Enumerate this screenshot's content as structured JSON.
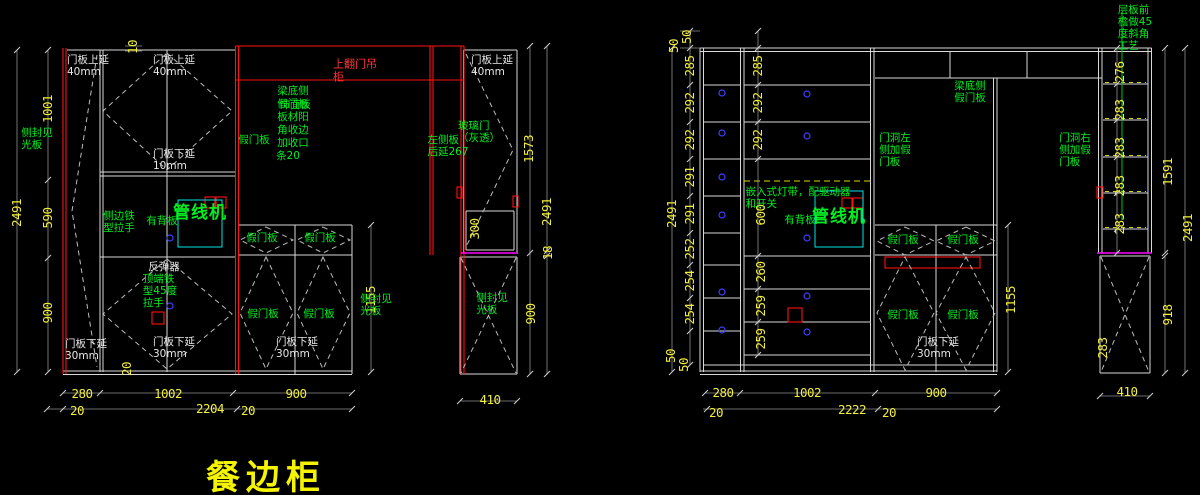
{
  "title": {
    "text": "餐边柜"
  },
  "palette": {
    "background": "#000000",
    "line_white": "#d9d9d9",
    "accent_red": "#ff1111",
    "annotation_green": "#00ee22",
    "dimension_yellow": "#f2ee3c",
    "highlight_cyan": "#00e5e5",
    "counter_magenta": "#ff00ff",
    "mark_blue": "#4040ff",
    "light_strip_yellow": "#d6d600",
    "title_yellow": "#f4f400"
  },
  "left_view": {
    "labels": [
      {
        "name": "dim-overall-height",
        "text": "2491",
        "x": 17,
        "y": 213,
        "rot": -90,
        "c": "dim"
      },
      {
        "name": "dim-upper-1001",
        "text": "1001",
        "x": 48,
        "y": 109,
        "rot": -90,
        "c": "dim"
      },
      {
        "name": "dim-mid-590",
        "text": "590",
        "x": 48,
        "y": 218,
        "rot": -90,
        "c": "dim"
      },
      {
        "name": "dim-lower-900",
        "text": "900",
        "x": 48,
        "y": 313,
        "rot": -90,
        "c": "dim"
      },
      {
        "name": "dim-top-offset-10",
        "text": "10",
        "x": 133,
        "y": 47,
        "rot": -90,
        "c": "dim"
      },
      {
        "name": "dim-bottom-offset-20",
        "text": "20",
        "x": 127,
        "y": 369,
        "rot": -90,
        "c": "dim"
      },
      {
        "name": "dim-width-280",
        "text": "280",
        "x": 82,
        "y": 394,
        "c": "dim"
      },
      {
        "name": "dim-width-1002",
        "text": "1002",
        "x": 168,
        "y": 394,
        "c": "dim"
      },
      {
        "name": "dim-width-900",
        "text": "900",
        "x": 296,
        "y": 394,
        "c": "dim"
      },
      {
        "name": "dim-gap-20-left",
        "text": "20",
        "x": 77,
        "y": 411,
        "c": "dim"
      },
      {
        "name": "dim-total-2204",
        "text": "2204",
        "x": 210,
        "y": 409,
        "c": "dim"
      },
      {
        "name": "dim-gap-20-right",
        "text": "20",
        "x": 248,
        "y": 411,
        "c": "dim"
      },
      {
        "name": "dim-glass-1573",
        "text": "1573",
        "x": 529,
        "y": 149,
        "rot": -90,
        "c": "dim"
      },
      {
        "name": "dim-right-overall-2491",
        "text": "2491",
        "x": 547,
        "y": 212,
        "rot": -90,
        "c": "dim"
      },
      {
        "name": "dim-gap-18",
        "text": "18",
        "x": 548,
        "y": 253,
        "rot": -90,
        "c": "dim"
      },
      {
        "name": "dim-box-300",
        "text": "300",
        "x": 475,
        "y": 229,
        "rot": -90,
        "c": "dim"
      },
      {
        "name": "dim-right-900",
        "text": "900",
        "x": 531,
        "y": 314,
        "rot": -90,
        "c": "dim"
      },
      {
        "name": "dim-1155",
        "text": "1155",
        "x": 371,
        "y": 300,
        "rot": -90,
        "c": "dim"
      },
      {
        "name": "dim-width-410",
        "text": "410",
        "x": 490,
        "y": 400,
        "c": "dim"
      },
      {
        "name": "label-door-extend-top-1",
        "text": "门板上延\n40mm",
        "x": 88,
        "y": 66,
        "c": "wht"
      },
      {
        "name": "label-door-extend-top-2",
        "text": "门板上延\n40mm",
        "x": 174,
        "y": 66,
        "c": "wht"
      },
      {
        "name": "label-door-extend-bottom-10",
        "text": "门板下延\n10mm",
        "x": 174,
        "y": 160,
        "c": "wht"
      },
      {
        "name": "label-door-extend-top-3",
        "text": "门板上延\n40mm",
        "x": 492,
        "y": 66,
        "c": "wht"
      },
      {
        "name": "label-rebounder",
        "text": "反弹器",
        "x": 164,
        "y": 267,
        "c": "wht"
      },
      {
        "name": "label-door-extend-bottom-30-a",
        "text": "门板下延\n30mm",
        "x": 86,
        "y": 350,
        "c": "wht"
      },
      {
        "name": "label-door-extend-bottom-30-b",
        "text": "门板下延\n30mm",
        "x": 174,
        "y": 348,
        "c": "wht"
      },
      {
        "name": "label-door-extend-bottom-30-c",
        "text": "门板下延\n30mm",
        "x": 297,
        "y": 348,
        "c": "wht"
      },
      {
        "name": "label-flip-up-cabinet",
        "text": "上翻门吊\n柜",
        "x": 355,
        "y": 71,
        "c": "red"
      },
      {
        "name": "label-side-finish-panel-left",
        "text": "侧封见\n光板",
        "x": 37,
        "y": 139,
        "c": "grn"
      },
      {
        "name": "label-side-iron-handle",
        "text": "侧边铁\n型拉手",
        "x": 119,
        "y": 222,
        "c": "grn"
      },
      {
        "name": "label-has-back-panel",
        "text": "有背板",
        "x": 162,
        "y": 221,
        "c": "grn"
      },
      {
        "name": "label-pipeline-machine",
        "text": "管线机",
        "x": 200,
        "y": 214,
        "c": "grn big"
      },
      {
        "name": "label-fake-door-panel-a",
        "text": "假门板",
        "x": 254,
        "y": 140,
        "c": "grn"
      },
      {
        "name": "label-fake-door-panel-b",
        "text": "假门板",
        "x": 262,
        "y": 238,
        "c": "grn"
      },
      {
        "name": "label-fake-door-panel-c",
        "text": "假门板",
        "x": 320,
        "y": 238,
        "c": "grn"
      },
      {
        "name": "label-fake-door-panel-d",
        "text": "假门板",
        "x": 263,
        "y": 314,
        "c": "grn"
      },
      {
        "name": "label-fake-door-panel-e",
        "text": "假门板",
        "x": 319,
        "y": 314,
        "c": "grn"
      },
      {
        "name": "label-beam-bottom-side",
        "text": "梁底侧",
        "x": 293,
        "y": 91,
        "c": "grn"
      },
      {
        "name": "label-fake-door-overlap",
        "text": "假门板",
        "x": 293,
        "y": 104,
        "c": "grn"
      },
      {
        "name": "label-veneer-overlap",
        "text": "饰面板",
        "x": 295,
        "y": 105,
        "c": "grn"
      },
      {
        "name": "label-panel-corner-1",
        "text": "板材阳",
        "x": 293,
        "y": 117,
        "c": "grn"
      },
      {
        "name": "label-panel-corner-2",
        "text": "角收边",
        "x": 293,
        "y": 130,
        "c": "grn"
      },
      {
        "name": "label-panel-corner-3",
        "text": "加收口",
        "x": 293,
        "y": 143,
        "c": "grn"
      },
      {
        "name": "label-panel-corner-4",
        "text": "条20",
        "x": 288,
        "y": 156,
        "c": "grn"
      },
      {
        "name": "label-glass-door",
        "text": "玻璃门\n（灰透）",
        "x": 479,
        "y": 132,
        "c": "grn"
      },
      {
        "name": "label-left-side-panel-extend",
        "text": "左侧板\n后延267",
        "x": 448,
        "y": 146,
        "c": "grn"
      },
      {
        "name": "label-side-finish-panel-right",
        "text": "侧封见\n光板",
        "x": 492,
        "y": 304,
        "c": "grn"
      },
      {
        "name": "label-side-finish-panel-mid",
        "text": "侧封见\n光板",
        "x": 376,
        "y": 305,
        "c": "grn"
      },
      {
        "name": "label-top-iron-45-handle",
        "text": "顶端铁\n型45度\n拉手",
        "x": 160,
        "y": 291,
        "c": "grn"
      }
    ]
  },
  "right_view": {
    "labels": [
      {
        "name": "dim-overall-height",
        "text": "2491",
        "x": 672,
        "y": 214,
        "rot": -90,
        "c": "dim"
      },
      {
        "name": "dim-top-50-a",
        "text": "50",
        "x": 674,
        "y": 46,
        "rot": -90,
        "c": "dim"
      },
      {
        "name": "dim-top-50-b",
        "text": "50",
        "x": 687,
        "y": 37,
        "rot": -90,
        "c": "dim"
      },
      {
        "name": "dim-shelf-285",
        "text": "285",
        "x": 690,
        "y": 66,
        "rot": -90,
        "c": "dim"
      },
      {
        "name": "dim-shelf-292-a",
        "text": "292",
        "x": 690,
        "y": 103,
        "rot": -90,
        "c": "dim"
      },
      {
        "name": "dim-shelf-292-b",
        "text": "292",
        "x": 690,
        "y": 140,
        "rot": -90,
        "c": "dim"
      },
      {
        "name": "dim-shelf-291-a",
        "text": "291",
        "x": 690,
        "y": 177,
        "rot": -90,
        "c": "dim"
      },
      {
        "name": "dim-shelf-291-b",
        "text": "291",
        "x": 690,
        "y": 214,
        "rot": -90,
        "c": "dim"
      },
      {
        "name": "dim-shelf-252",
        "text": "252",
        "x": 690,
        "y": 249,
        "rot": -90,
        "c": "dim"
      },
      {
        "name": "dim-shelf-254-a",
        "text": "254",
        "x": 690,
        "y": 281,
        "rot": -90,
        "c": "dim"
      },
      {
        "name": "dim-shelf-254-b",
        "text": "254",
        "x": 690,
        "y": 314,
        "rot": -90,
        "c": "dim"
      },
      {
        "name": "dim-bottom-50-a",
        "text": "50",
        "x": 671,
        "y": 356,
        "rot": -90,
        "c": "dim"
      },
      {
        "name": "dim-bottom-50-b",
        "text": "50",
        "x": 684,
        "y": 365,
        "rot": -90,
        "c": "dim"
      },
      {
        "name": "dim-col2-285",
        "text": "285",
        "x": 758,
        "y": 66,
        "rot": -90,
        "c": "dim"
      },
      {
        "name": "dim-col2-292-a",
        "text": "292",
        "x": 758,
        "y": 103,
        "rot": -90,
        "c": "dim"
      },
      {
        "name": "dim-col2-292-b",
        "text": "292",
        "x": 758,
        "y": 140,
        "rot": -90,
        "c": "dim"
      },
      {
        "name": "dim-col2-600",
        "text": "600",
        "x": 761,
        "y": 215,
        "rot": -90,
        "c": "dim"
      },
      {
        "name": "dim-col2-260",
        "text": "260",
        "x": 761,
        "y": 272,
        "rot": -90,
        "c": "dim"
      },
      {
        "name": "dim-col2-259-a",
        "text": "259",
        "x": 761,
        "y": 306,
        "rot": -90,
        "c": "dim"
      },
      {
        "name": "dim-col2-259-b",
        "text": "259",
        "x": 761,
        "y": 339,
        "rot": -90,
        "c": "dim"
      },
      {
        "name": "dim-width-280",
        "text": "280",
        "x": 723,
        "y": 393,
        "c": "dim"
      },
      {
        "name": "dim-width-1002",
        "text": "1002",
        "x": 807,
        "y": 393,
        "c": "dim"
      },
      {
        "name": "dim-width-900",
        "text": "900",
        "x": 936,
        "y": 393,
        "c": "dim"
      },
      {
        "name": "dim-gap-20-left",
        "text": "20",
        "x": 716,
        "y": 413,
        "c": "dim"
      },
      {
        "name": "dim-total-2222",
        "text": "2222",
        "x": 852,
        "y": 410,
        "c": "dim"
      },
      {
        "name": "dim-gap-20-right",
        "text": "20",
        "x": 889,
        "y": 413,
        "c": "dim"
      },
      {
        "name": "dim-1155",
        "text": "1155",
        "x": 1011,
        "y": 300,
        "rot": -90,
        "c": "dim"
      },
      {
        "name": "dim-col4-276",
        "text": "276",
        "x": 1120,
        "y": 72,
        "rot": -90,
        "c": "dim"
      },
      {
        "name": "dim-col4-283-a",
        "text": "283",
        "x": 1120,
        "y": 110,
        "rot": -90,
        "c": "dim"
      },
      {
        "name": "dim-col4-283-b",
        "text": "283",
        "x": 1120,
        "y": 148,
        "rot": -90,
        "c": "dim"
      },
      {
        "name": "dim-col4-283-c",
        "text": "283",
        "x": 1120,
        "y": 186,
        "rot": -90,
        "c": "dim"
      },
      {
        "name": "dim-col4-283-d",
        "text": "283",
        "x": 1120,
        "y": 224,
        "rot": -90,
        "c": "dim"
      },
      {
        "name": "dim-col4-283-e",
        "text": "283",
        "x": 1103,
        "y": 348,
        "rot": -90,
        "c": "dim"
      },
      {
        "name": "dim-1591",
        "text": "1591",
        "x": 1168,
        "y": 172,
        "rot": -90,
        "c": "dim"
      },
      {
        "name": "dim-right-2491",
        "text": "2491",
        "x": 1188,
        "y": 228,
        "rot": -90,
        "c": "dim"
      },
      {
        "name": "dim-918",
        "text": "918",
        "x": 1168,
        "y": 315,
        "rot": -90,
        "c": "dim"
      },
      {
        "name": "dim-width-410",
        "text": "410",
        "x": 1127,
        "y": 392,
        "c": "dim"
      },
      {
        "name": "label-light-strip",
        "text": "嵌入式灯带，配驱动器\n和开关",
        "x": 798,
        "y": 198,
        "c": "grn"
      },
      {
        "name": "label-has-back-panel",
        "text": "有背板",
        "x": 800,
        "y": 220,
        "c": "grn"
      },
      {
        "name": "label-pipeline-machine",
        "text": "管线机",
        "x": 839,
        "y": 218,
        "c": "grn big"
      },
      {
        "name": "label-beam-bottom-fake-door",
        "text": "梁底侧\n假门板",
        "x": 970,
        "y": 92,
        "c": "grn"
      },
      {
        "name": "label-doorway-left-fake",
        "text": "门洞左\n侧加假\n门板",
        "x": 895,
        "y": 150,
        "c": "grn"
      },
      {
        "name": "label-doorway-right-fake",
        "text": "门洞右\n侧加假\n门板",
        "x": 1075,
        "y": 150,
        "c": "grn"
      },
      {
        "name": "label-shelf-front-bevel",
        "text": "层板前\n檐做45\n度斜角\n工艺",
        "x": 1135,
        "y": 28,
        "c": "grn"
      },
      {
        "name": "label-fake-door-panel-a",
        "text": "假门板",
        "x": 903,
        "y": 240,
        "c": "grn"
      },
      {
        "name": "label-fake-door-panel-b",
        "text": "假门板",
        "x": 963,
        "y": 240,
        "c": "grn"
      },
      {
        "name": "label-fake-door-panel-c",
        "text": "假门板",
        "x": 903,
        "y": 315,
        "c": "grn"
      },
      {
        "name": "label-fake-door-panel-d",
        "text": "假门板",
        "x": 963,
        "y": 315,
        "c": "grn"
      },
      {
        "name": "label-door-extend-bottom-30",
        "text": "门板下延\n30mm",
        "x": 938,
        "y": 348,
        "c": "wht"
      }
    ]
  }
}
